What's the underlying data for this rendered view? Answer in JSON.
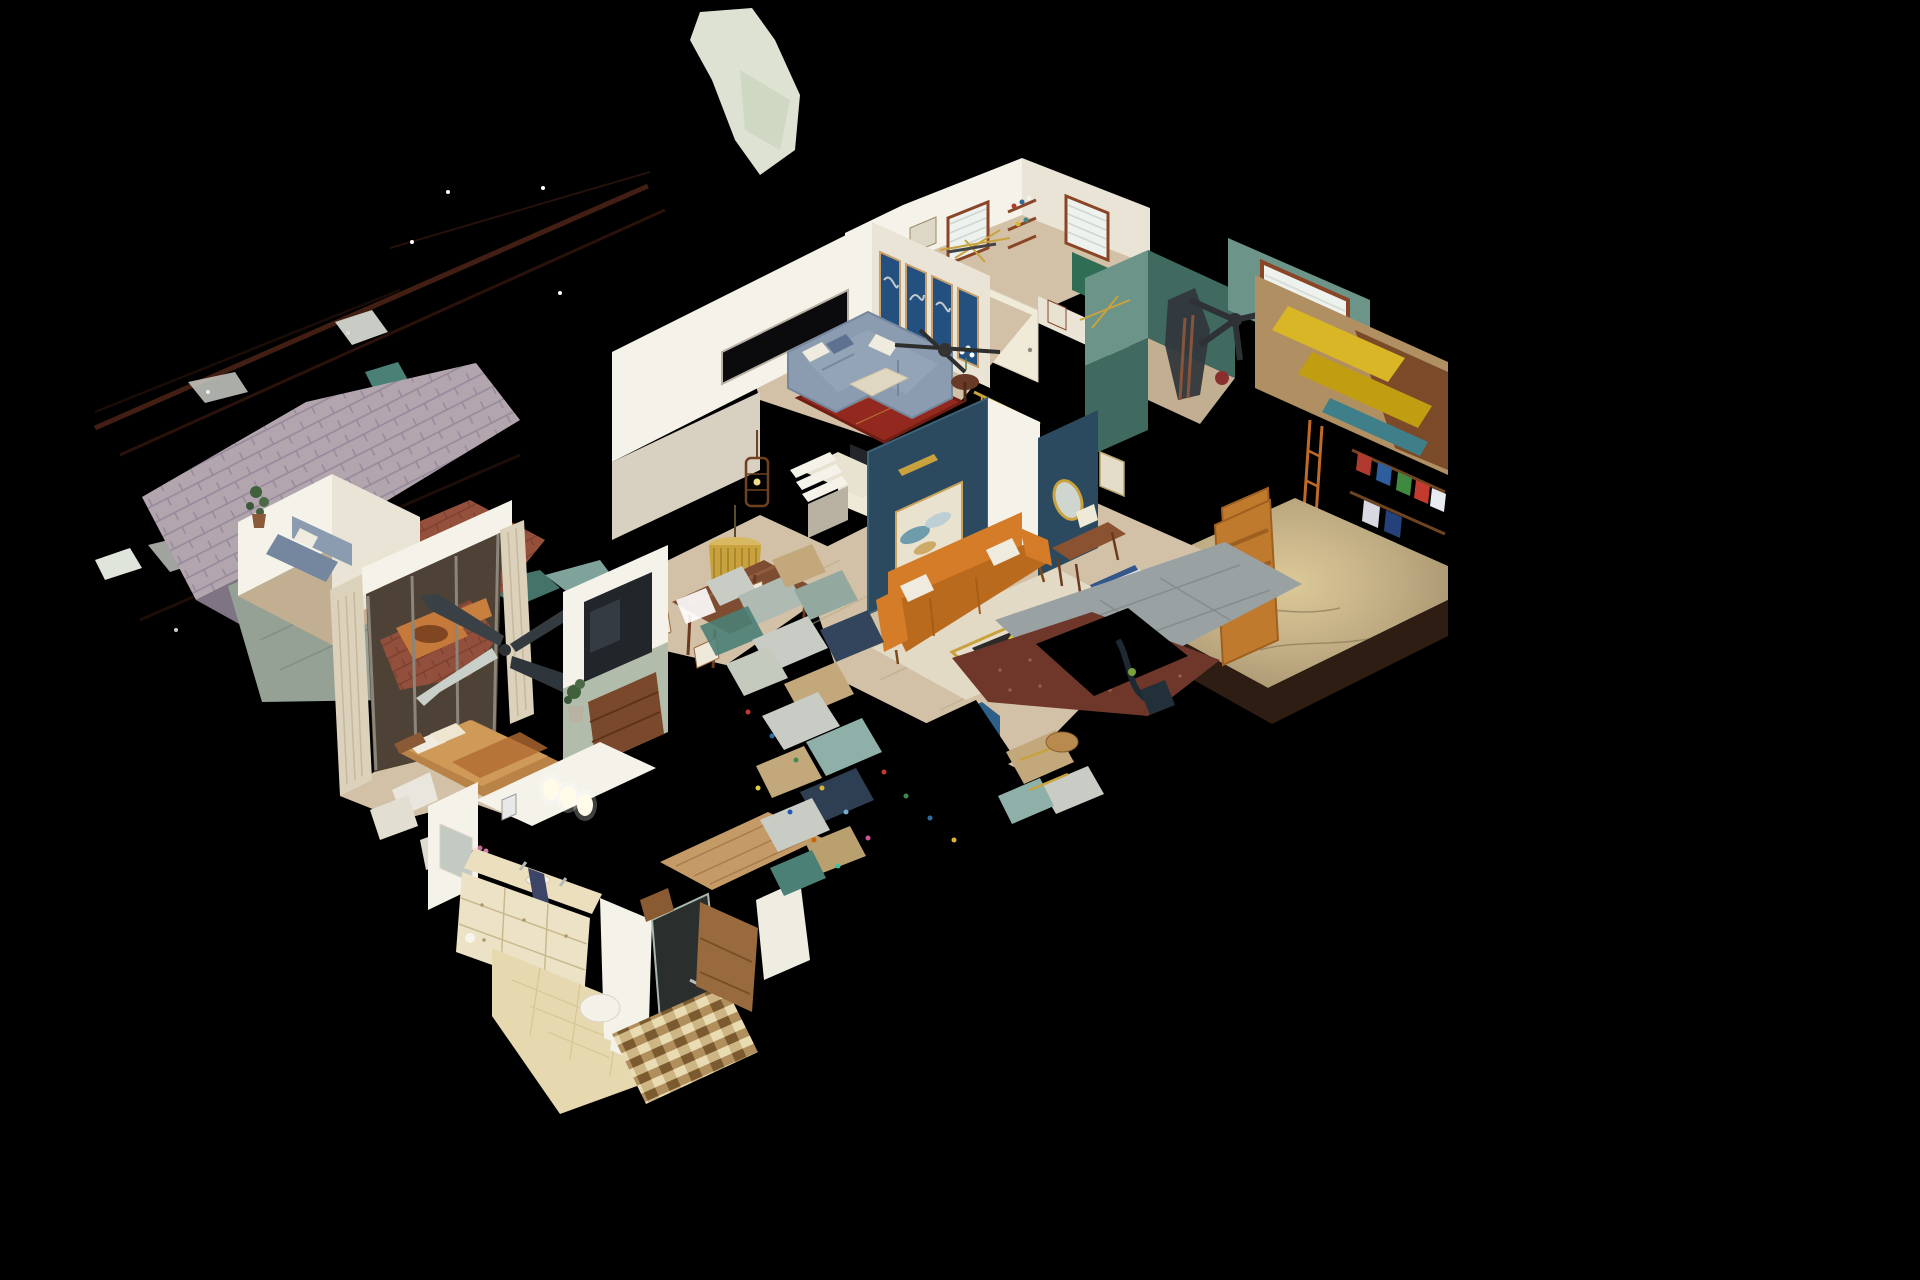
{
  "scene": {
    "aria_label": "3D dollhouse cutaway view of a scanned single-story house floating on a black background",
    "view_type": "dollhouse-3d",
    "rooms": [
      "office bedroom with blinds windows and shelves",
      "family room with gray sectional, blue art panels and red oriental rug",
      "kitchen nook with microwave and stairs",
      "dining area with wood table and gold fringe chandelier",
      "living room with navy accent wall, abstract painting and orange sofa",
      "entry hall with navy panel, gold oval mirror and open wood door",
      "teal exercise room with window and equipment",
      "garage with hanging yellow kayaks, gear shelves and concrete floor",
      "master bedroom with sliding door to hot-tub patio, floating ceiling fan",
      "bathroom with cream vanity, tile floor and mosaic shower",
      "shingled roof section, tarp and brick patio",
      "scan-noise debris, power-line streaks and floating fragments"
    ]
  },
  "palette": {
    "bg": "#000000",
    "wallBright": "#f5f2ea",
    "wallCream": "#eae4d6",
    "wallShade": "#d8d1c2",
    "floorWood": "#d2c1a6",
    "floorWoodDk": "#c2ae90",
    "rugCream": "#e3dac6",
    "rugRed": "#93291e",
    "sofaGray": "#8b9cb0",
    "sofaGrayDk": "#74879f",
    "pillowWhite": "#efebdf",
    "ottoman": "#e0d7c0",
    "navyWall": "#2b4a5f",
    "navyArt": "#24507f",
    "artCanvas": "#e9e2cf",
    "tealWall": "#6d9489",
    "tealWallDk": "#40695f",
    "greenAccent": "#2f6e54",
    "sofaOrange": "#d47c28",
    "sofaOrangeDk": "#b96a1d",
    "doorOrange": "#bf7a2e",
    "wood": "#8a5230",
    "gold": "#c9a23e",
    "concrete": "#b5a27e",
    "concreteLt": "#dcc998",
    "kayakYellow": "#d9b626",
    "tileBeige": "#e7d9af",
    "marble": "#ecdfbd",
    "curtain": "#dcd1ba",
    "roofShingle": "#b2a5ad",
    "roofShingleDk": "#95889b",
    "tarp": "#95a194",
    "brick": "#95503c",
    "gravel": "#6e372a",
    "paver": "#9aa1a3",
    "tvDark": "#22262b",
    "blinds": "#eef2ee",
    "trim": "#8a4527",
    "mirror": "#c3c9c3",
    "blueRug": "#34578a",
    "blueChair": "#2d5f88",
    "hotTub": "#c5793a",
    "sage": "#b2bcab",
    "debrisSilver": "#c9ccc5",
    "debrisTeal": "#4b8076",
    "debrisTan": "#c3a87c",
    "debrisNavy": "#33455c",
    "lineStreak": "#4a2115"
  }
}
